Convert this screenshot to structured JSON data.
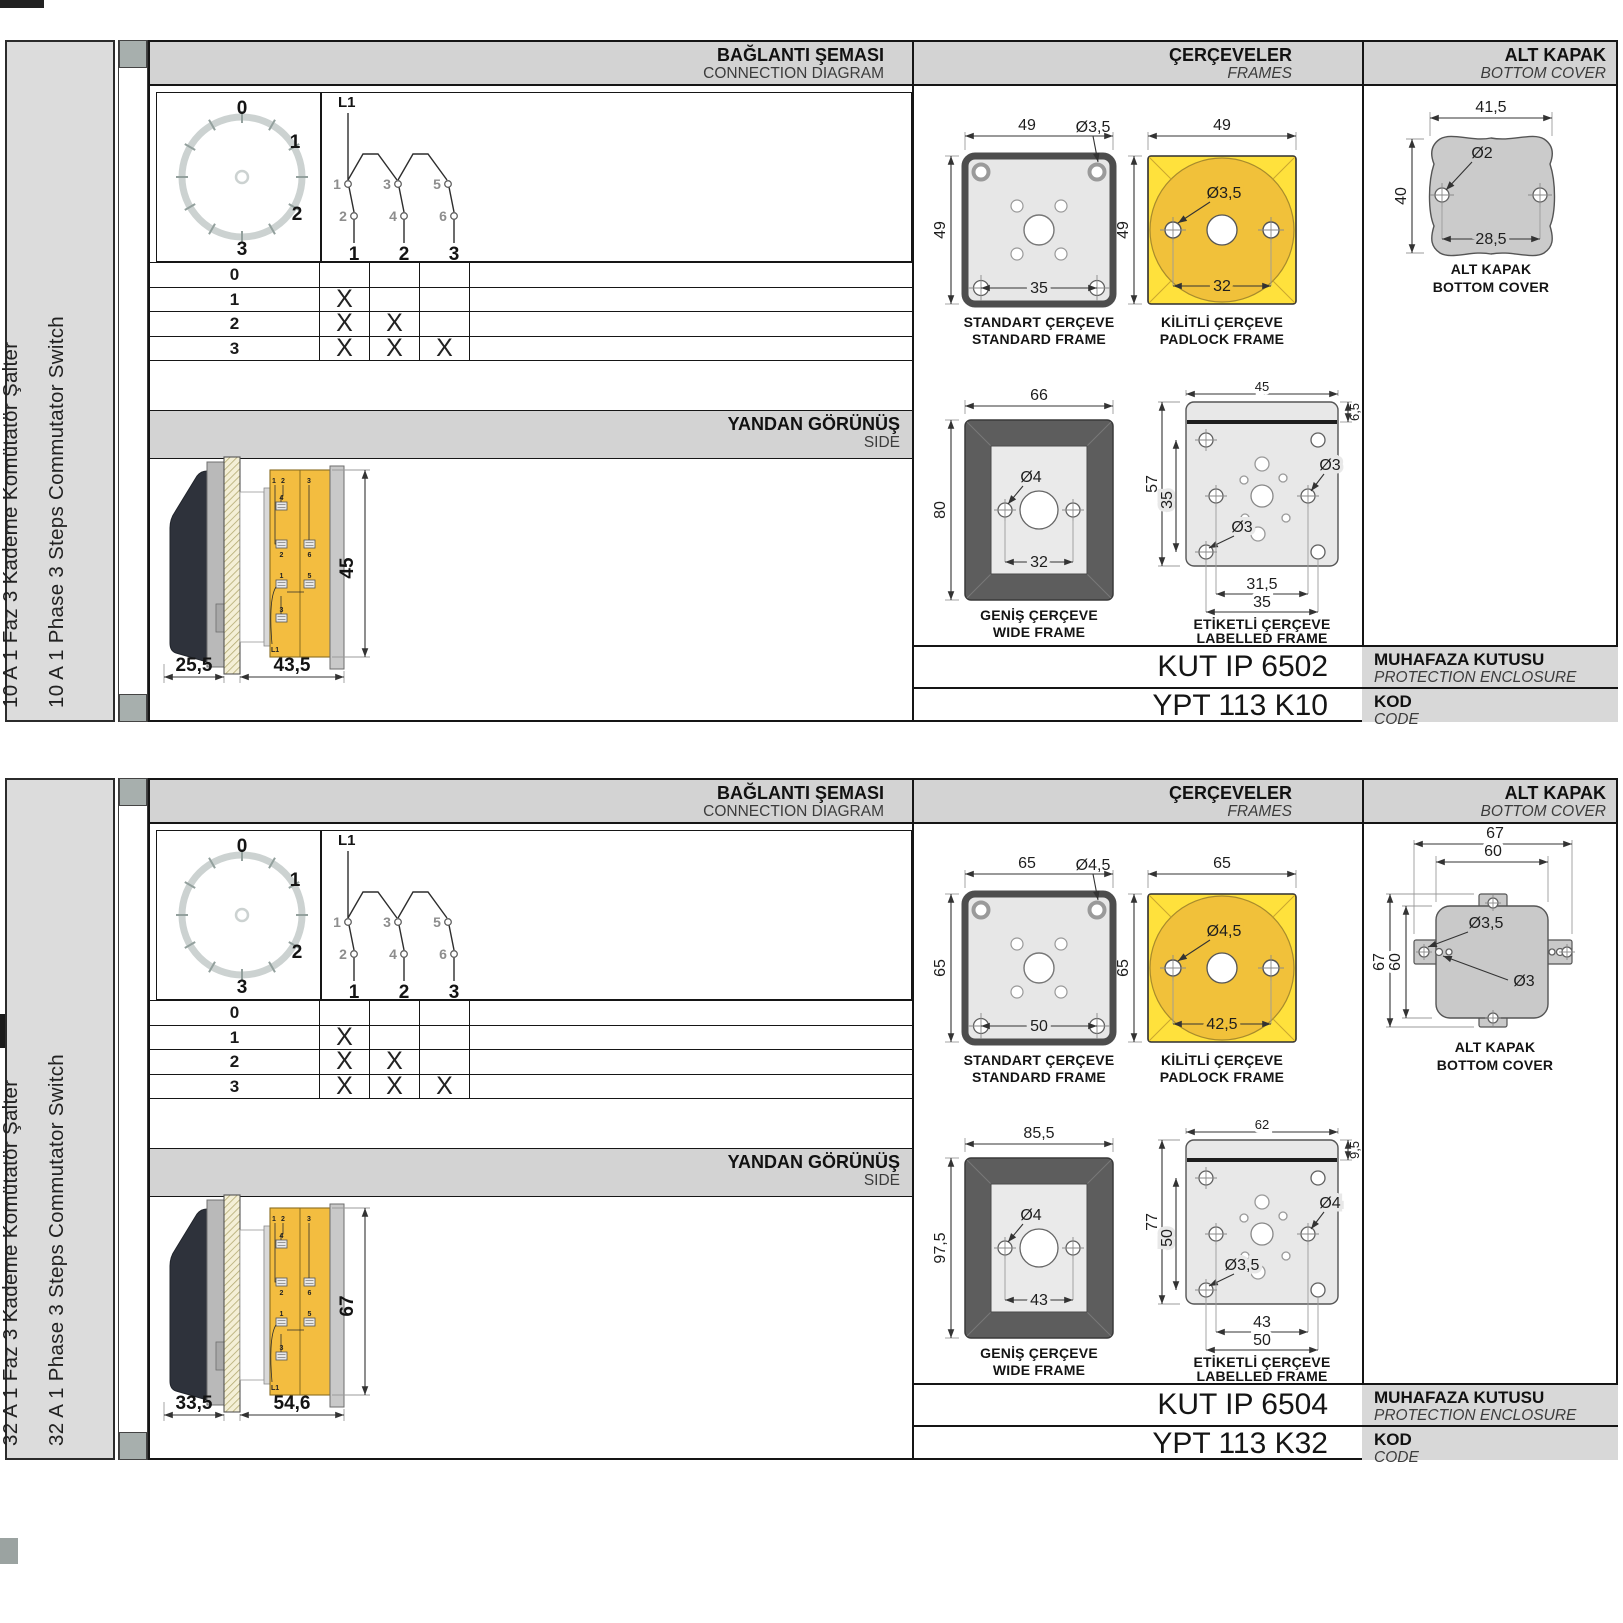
{
  "colors": {
    "header_bg": "#d3d3d3",
    "label_bar_bg": "#dcdcdc",
    "spine_square": "#a7afad",
    "frame_yellow": "#ffe13c",
    "circle_amber": "#f1c13a",
    "body_yellow": "#f3bd40",
    "frame_gray": "#e7e7e7",
    "dark_frame": "#5d5d5d",
    "cover_gray": "#cbcbcb"
  },
  "sections": [
    {
      "side_label_tr": "10 A 1 Faz 3 Kademe Komütatör Şalter",
      "side_label_en": "10 A 1 Phase 3 Steps Commutator Switch",
      "headers": {
        "connection_tr": "BAĞLANTI ŞEMASI",
        "connection_en": "CONNECTION DIAGRAM",
        "frames_tr": "ÇERÇEVELER",
        "frames_en": "FRAMES",
        "cover_tr": "ALT KAPAK",
        "cover_en": "BOTTOM COVER",
        "side_tr": "YANDAN GÖRÜNÜŞ",
        "side_en": "SIDE"
      },
      "dial": {
        "positions": [
          "0",
          "1",
          "2",
          "3"
        ]
      },
      "schematic": {
        "supply": "L1",
        "top_contacts": [
          "1",
          "3",
          "5"
        ],
        "bottom_contacts": [
          "2",
          "4",
          "6"
        ],
        "poles": [
          "1",
          "2",
          "3"
        ]
      },
      "step_table": {
        "rows": [
          {
            "step": "0",
            "marks": [
              "",
              "",
              ""
            ]
          },
          {
            "step": "1",
            "marks": [
              "X",
              "",
              ""
            ]
          },
          {
            "step": "2",
            "marks": [
              "X",
              "X",
              ""
            ]
          },
          {
            "step": "3",
            "marks": [
              "X",
              "X",
              "X"
            ]
          }
        ]
      },
      "side_view": {
        "dims": {
          "front": "25,5",
          "body": "43,5",
          "height": "45"
        },
        "labels": [
          "1",
          "2",
          "3",
          "4",
          "2",
          "6",
          "1",
          "5",
          "3",
          "L1"
        ]
      },
      "standard_frame": {
        "title_tr": "STANDART ÇERÇEVE",
        "title_en": "STANDARD FRAME",
        "w": "49",
        "h": "49",
        "hole": "Ø3,5",
        "centers": "35"
      },
      "padlock_frame": {
        "title_tr": "KİLİTLİ ÇERÇEVE",
        "title_en": "PADLOCK FRAME",
        "w": "49",
        "h": "49",
        "hole": "Ø3,5",
        "centers": "32"
      },
      "wide_frame": {
        "title_tr": "GENİŞ ÇERÇEVE",
        "title_en": "WIDE FRAME",
        "w": "66",
        "h": "80",
        "hole": "Ø4",
        "centers": "32"
      },
      "labelled_frame": {
        "title_tr": "ETİKETLİ ÇERÇEVE",
        "title_en": "LABELLED FRAME",
        "w": "45",
        "strip": "6,5",
        "h": "57",
        "inner": "35",
        "hole_right": "Ø3",
        "hole_left": "Ø3",
        "centers": "31,5",
        "outer": "35"
      },
      "bottom_cover": {
        "title_tr": "ALT KAPAK",
        "title_en": "BOTTOM COVER",
        "w": "41,5",
        "hole": "Ø2",
        "h": "40",
        "centers": "28,5"
      },
      "enclosure": {
        "value": "KUT IP 6502",
        "label_tr": "MUHAFAZA KUTUSU",
        "label_en": "PROTECTION ENCLOSURE"
      },
      "code": {
        "value": "YPT 113 K10",
        "label_tr": "KOD",
        "label_en": "CODE"
      }
    },
    {
      "side_label_tr": "32 A 1 Faz 3 Kademe Komütatör Şalter",
      "side_label_en": "32 A 1 Phase 3 Steps Commutator Switch",
      "headers": {
        "connection_tr": "BAĞLANTI ŞEMASI",
        "connection_en": "CONNECTION DIAGRAM",
        "frames_tr": "ÇERÇEVELER",
        "frames_en": "FRAMES",
        "cover_tr": "ALT KAPAK",
        "cover_en": "BOTTOM COVER",
        "side_tr": "YANDAN GÖRÜNÜŞ",
        "side_en": "SIDE"
      },
      "dial": {
        "positions": [
          "0",
          "1",
          "2",
          "3"
        ]
      },
      "schematic": {
        "supply": "L1",
        "top_contacts": [
          "1",
          "3",
          "5"
        ],
        "bottom_contacts": [
          "2",
          "4",
          "6"
        ],
        "poles": [
          "1",
          "2",
          "3"
        ]
      },
      "step_table": {
        "rows": [
          {
            "step": "0",
            "marks": [
              "",
              "",
              ""
            ]
          },
          {
            "step": "1",
            "marks": [
              "X",
              "",
              ""
            ]
          },
          {
            "step": "2",
            "marks": [
              "X",
              "X",
              ""
            ]
          },
          {
            "step": "3",
            "marks": [
              "X",
              "X",
              "X"
            ]
          }
        ]
      },
      "side_view": {
        "dims": {
          "front": "33,5",
          "body": "54,6",
          "height": "67"
        },
        "labels": [
          "1",
          "2",
          "3",
          "4",
          "2",
          "6",
          "1",
          "5",
          "3",
          "L1"
        ]
      },
      "standard_frame": {
        "title_tr": "STANDART ÇERÇEVE",
        "title_en": "STANDARD FRAME",
        "w": "65",
        "h": "65",
        "hole": "Ø4,5",
        "centers": "50"
      },
      "padlock_frame": {
        "title_tr": "KİLİTLİ ÇERÇEVE",
        "title_en": "PADLOCK FRAME",
        "w": "65",
        "h": "65",
        "hole": "Ø4,5",
        "centers": "42,5"
      },
      "wide_frame": {
        "title_tr": "GENİŞ ÇERÇEVE",
        "title_en": "WIDE FRAME",
        "w": "85,5",
        "h": "97,5",
        "hole": "Ø4",
        "centers": "43"
      },
      "labelled_frame": {
        "title_tr": "ETİKETLİ ÇERÇEVE",
        "title_en": "LABELLED FRAME",
        "w": "62",
        "strip": "9,5",
        "h": "77",
        "inner": "50",
        "hole_right": "Ø4",
        "hole_left": "Ø3,5",
        "centers": "43",
        "outer": "50"
      },
      "bottom_cover": {
        "title_tr": "ALT KAPAK",
        "title_en": "BOTTOM COVER",
        "w_outer": "67",
        "w_inner": "60",
        "h_outer": "67",
        "h_inner": "60",
        "hole_big": "Ø3,5",
        "hole_small": "Ø3"
      },
      "enclosure": {
        "value": "KUT IP 6504",
        "label_tr": "MUHAFAZA KUTUSU",
        "label_en": "PROTECTION ENCLOSURE"
      },
      "code": {
        "value": "YPT 113 K32",
        "label_tr": "KOD",
        "label_en": "CODE"
      }
    }
  ]
}
